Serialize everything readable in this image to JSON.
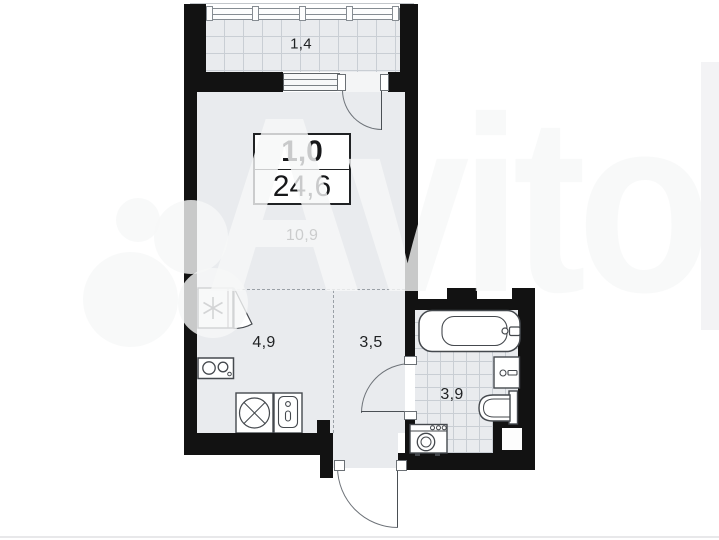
{
  "watermark": {
    "brand": "Avito"
  },
  "floor_plan": {
    "summary": {
      "rooms_count": "1,0",
      "total_area": "24,6"
    },
    "rooms": [
      {
        "id": "balcony",
        "area": "1,4"
      },
      {
        "id": "living-room",
        "area": "10,9"
      },
      {
        "id": "kitchen",
        "area": "4,9"
      },
      {
        "id": "hallway",
        "area": "3,5"
      },
      {
        "id": "bathroom",
        "area": "3,9"
      }
    ],
    "fixtures": [
      "fridge",
      "stove",
      "washing-machine",
      "kitchen-sink",
      "bathtub",
      "wash-basin",
      "toilet",
      "bathroom-washer"
    ],
    "colors": {
      "wall": "#121212",
      "floor": "#e9ebee",
      "tile_line": "#c9ced4",
      "fixture_outline": "#45494e",
      "dashed_zone_line": "#9aa0a6",
      "label_text": "#1f2123"
    }
  }
}
